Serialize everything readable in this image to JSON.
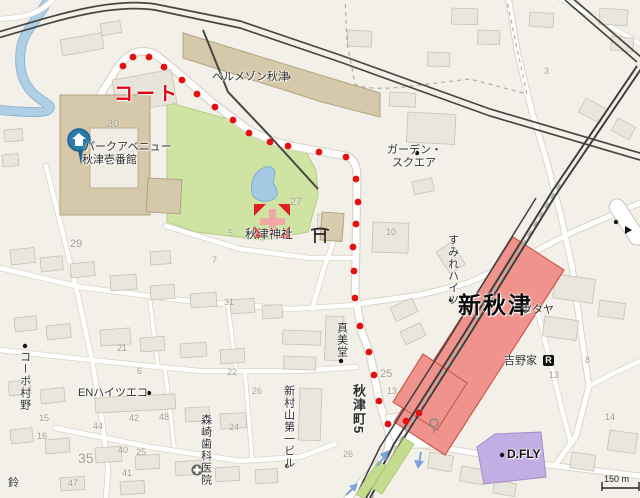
{
  "map": {
    "scale_label": "150 m",
    "labels": {
      "court": "コート",
      "belle_maison": "ベルメゾン秋津",
      "park_avenue_1": "パークアベニュー",
      "park_avenue_2": "秋津壱番館",
      "garden_square_1": "ガーデン・",
      "garden_square_2": "スクエア",
      "akitsu_shrine": "秋津神社",
      "sumire_heights": "すみれハイツ",
      "shin_akitsu": "新秋津",
      "tsutaya": "ツタヤ",
      "yoshinoya": "吉野家",
      "yoshinoya_r": "R",
      "mamido": "真美堂",
      "akitsu_cho5": "秋津町5",
      "corpo_murano": "コーポ村野",
      "en_heights": "ENハイツエコ",
      "morisaki_dental": "森崎歯科医院",
      "shinmurayama_bldg": "新村山第一ビル",
      "dfly": "D.FLY",
      "suzu": "鈴"
    },
    "numbers": [
      {
        "t": "30",
        "x": 107,
        "y": 118,
        "s": 11
      },
      {
        "t": "29",
        "x": 70,
        "y": 238,
        "s": 11
      },
      {
        "t": "27",
        "x": 290,
        "y": 196,
        "s": 11
      },
      {
        "t": "10",
        "x": 386,
        "y": 227
      },
      {
        "t": "5",
        "x": 228,
        "y": 228
      },
      {
        "t": "7",
        "x": 212,
        "y": 255
      },
      {
        "t": "31",
        "x": 224,
        "y": 297
      },
      {
        "t": "25",
        "x": 380,
        "y": 368,
        "s": 11
      },
      {
        "t": "13",
        "x": 387,
        "y": 386
      },
      {
        "t": "35",
        "x": 78,
        "y": 450,
        "s": 14
      },
      {
        "t": "44",
        "x": 93,
        "y": 421
      },
      {
        "t": "42",
        "x": 129,
        "y": 413
      },
      {
        "t": "48",
        "x": 159,
        "y": 412
      },
      {
        "t": "40",
        "x": 118,
        "y": 445
      },
      {
        "t": "25",
        "x": 136,
        "y": 447
      },
      {
        "t": "41",
        "x": 122,
        "y": 468
      },
      {
        "t": "47",
        "x": 68,
        "y": 478
      },
      {
        "t": "15",
        "x": 39,
        "y": 413
      },
      {
        "t": "16",
        "x": 37,
        "y": 431
      },
      {
        "t": "21",
        "x": 117,
        "y": 343
      },
      {
        "t": "6",
        "x": 137,
        "y": 366
      },
      {
        "t": "22",
        "x": 227,
        "y": 367
      },
      {
        "t": "24",
        "x": 229,
        "y": 422
      },
      {
        "t": "26",
        "x": 252,
        "y": 386
      },
      {
        "t": "26",
        "x": 343,
        "y": 449
      },
      {
        "t": "3",
        "x": 544,
        "y": 66
      },
      {
        "t": "13",
        "x": 549,
        "y": 370
      },
      {
        "t": "14",
        "x": 605,
        "y": 412
      },
      {
        "t": "8",
        "x": 585,
        "y": 355
      }
    ],
    "route_dots": [
      [
        123,
        66
      ],
      [
        133,
        57
      ],
      [
        149,
        57
      ],
      [
        164,
        67
      ],
      [
        182,
        80
      ],
      [
        197,
        94
      ],
      [
        215,
        107
      ],
      [
        233,
        120
      ],
      [
        249,
        133
      ],
      [
        270,
        142
      ],
      [
        288,
        146
      ],
      [
        319,
        152
      ],
      [
        346,
        157
      ],
      [
        356,
        179
      ],
      [
        358,
        202
      ],
      [
        356,
        224
      ],
      [
        353,
        247
      ],
      [
        354,
        271
      ],
      [
        355,
        298
      ],
      [
        360,
        326
      ],
      [
        369,
        352
      ],
      [
        374,
        375
      ],
      [
        379,
        401
      ],
      [
        388,
        424
      ],
      [
        406,
        421
      ],
      [
        419,
        413
      ]
    ],
    "colors": {
      "background": "#f3f0e9",
      "road": "#ffffff",
      "road_casing": "#d9d5c9",
      "building": "#e9e6dd",
      "building_tan": "#d6c9ab",
      "park_green": "#cfe3a3",
      "pond_blue": "#a5c9e3",
      "river_blue": "#aecfe6",
      "railway_dark": "#46463f",
      "station_pink": "#ef938c",
      "station_border": "#cc5b52",
      "platform_green": "#c3dc8e",
      "dfly_purple": "#c3aee3",
      "route_red": "#e31010",
      "court_red": "#e60012",
      "pin_blue": "#2a7cab"
    }
  }
}
